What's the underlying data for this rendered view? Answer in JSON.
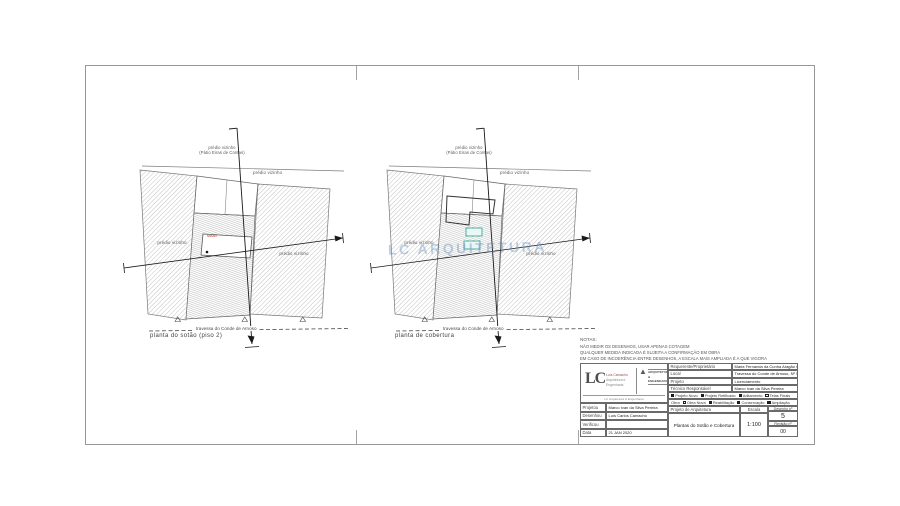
{
  "plans": {
    "left": {
      "caption": "planta do sotão (piso 2)",
      "street": "travessa do Conde de Arnoso",
      "neighbor_top_1": "prédio vizinho",
      "neighbor_top_2": "(Pátio Eiras de Contas)",
      "neighbor_right": "prédio vizinho",
      "neighbor_left_inner": "prédio vizinho",
      "neighbor_right_inner": "prédio vizinho",
      "room_label": "sotão"
    },
    "right": {
      "caption": "planta de cobertura",
      "street": "travessa do Conde de Arnoso",
      "neighbor_top_1": "prédio vizinho",
      "neighbor_top_2": "(Pátio Eiras de Contas)",
      "neighbor_right": "prédio vizinho",
      "neighbor_left_inner": "prédio vizinho",
      "neighbor_right_inner": "prédio vizinho",
      "watermark": "LC ARQUITETURA"
    }
  },
  "notes": {
    "title": "NOTAS:",
    "lines": [
      "NÃO MEDIR OS DESENHOS, USAR APENAS COTAGEM",
      "QUALQUER MEDIDA INDICADA É SUJEITA A CONFIRMAÇÃO EM OBRA",
      "EM CASO DE INCOERÊNCIA ENTRE DESENHOS, A ESCALA MAIS AMPLIADA É A QUE VIGORA"
    ]
  },
  "titleblock": {
    "logo": {
      "initials": "LC",
      "middle_lines": [
        "Luís Camacho",
        "Arquitetura e",
        "Engenharia"
      ],
      "triangle_icon": "▲",
      "firm_name_1": "ARQUITETURA",
      "firm_name_2": "& ENGENHARIA",
      "bottom_line": "LC Arquitetura & Engenharia"
    },
    "left_rows": [
      {
        "label": "Projetou",
        "value": "Marco Ivan da Silva Pereira"
      },
      {
        "label": "Desenhou",
        "value": "Luís Carlos Camacho"
      },
      {
        "label": "Verificou",
        "value": ""
      },
      {
        "label": "Data",
        "value": "21 JAN 2020"
      }
    ],
    "info_rows": [
      {
        "label": "Requerente/Proprietário",
        "value": "Maria Fernanda da Cunha Aragão Gales"
      },
      {
        "label": "Local",
        "value": "Travessa do Conde de Arnoso, Nº 57"
      },
      {
        "label": "Projeto",
        "value": "Licenciamento"
      },
      {
        "label": "Técnico Responsável",
        "value": "Marco Ivan da Silva Pereira"
      }
    ],
    "legend1": [
      {
        "label": "Projeto Novo"
      },
      {
        "label": "Projeto Retificado"
      },
      {
        "label": "Aditamento"
      },
      {
        "label": "Telas Finais"
      }
    ],
    "legend2_prefix": "Obra",
    "legend2": [
      {
        "label": "Obra Nova"
      },
      {
        "label": "Reabilitação"
      },
      {
        "label": "Conservação"
      },
      {
        "label": "Ampliação"
      }
    ],
    "project_type": "Projeto de Arquitetura",
    "drawing_title": "Plantas do Sotão e Cobertura",
    "scale_label": "Escala",
    "scale_value": "1:100",
    "sheet_no_label": "Desenho nº",
    "sheet_no_value": "5",
    "revision_label": "Revisão nº",
    "revision_value": "00"
  }
}
